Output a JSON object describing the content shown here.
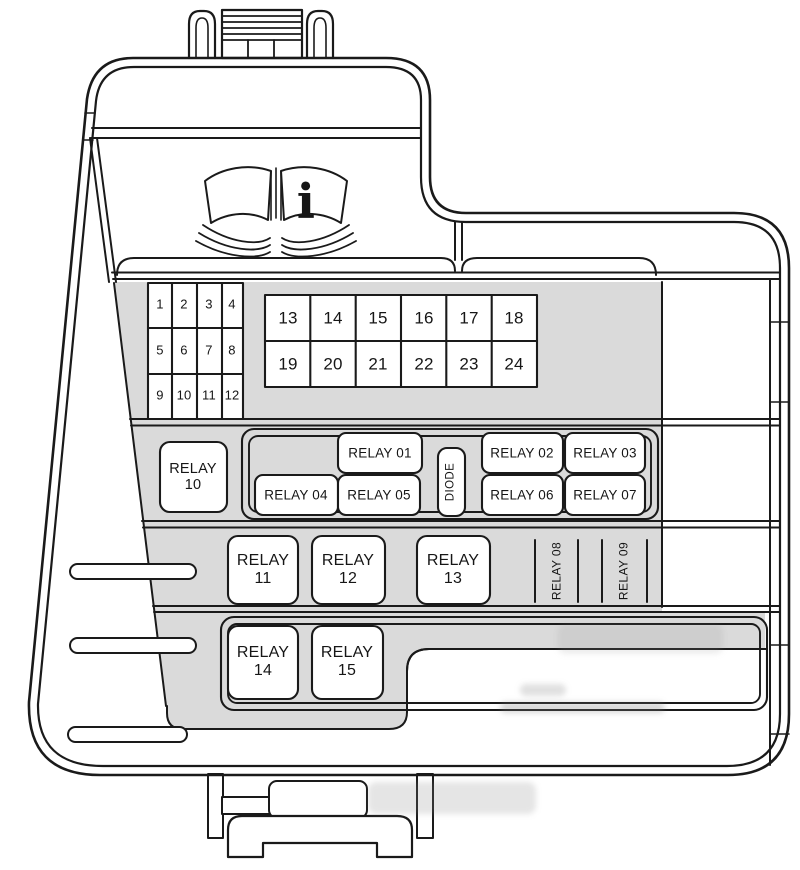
{
  "colors": {
    "line": "#1a1a1a",
    "panel_gray": "#dadada",
    "background": "#ffffff"
  },
  "info_icon": {
    "symbol": "i"
  },
  "mini_fuse_labels": [
    "1",
    "2",
    "3",
    "4",
    "5",
    "6",
    "7",
    "8",
    "9",
    "10",
    "11",
    "12"
  ],
  "maxi_fuse_labels": [
    "13",
    "14",
    "15",
    "16",
    "17",
    "18",
    "19",
    "20",
    "21",
    "22",
    "23",
    "24"
  ],
  "relays": {
    "relay10": "RELAY\n10",
    "relay01": "RELAY 01",
    "relay04": "RELAY 04",
    "relay05": "RELAY 05",
    "diode": "DIODE",
    "relay02": "RELAY 02",
    "relay03": "RELAY 03",
    "relay06": "RELAY 06",
    "relay07": "RELAY 07",
    "relay11": "RELAY\n11",
    "relay12": "RELAY\n12",
    "relay13": "RELAY\n13",
    "relay08": "RELAY 08",
    "relay09": "RELAY 09",
    "relay14": "RELAY\n14",
    "relay15": "RELAY\n15"
  }
}
